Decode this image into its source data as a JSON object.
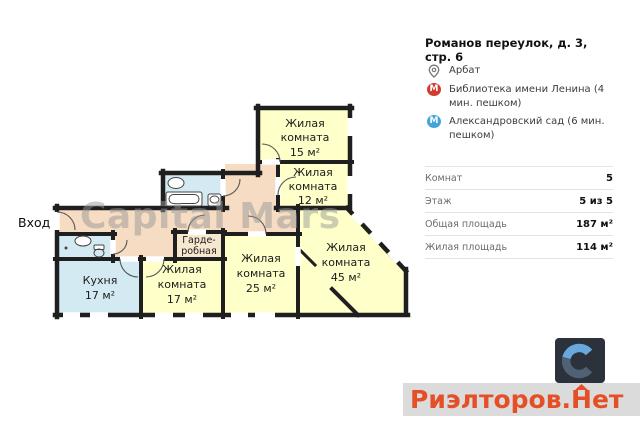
{
  "colors": {
    "wall": "#1f1f1f",
    "room_yellow": "#ffffc9",
    "room_blue": "#d3eaf2",
    "corridor_peach": "#f6dcc2",
    "wardrobe_peach": "#f8e7cf",
    "watermark_grey": "#9a9a9a",
    "metro_red": "#d23b33",
    "metro_blue": "#42a4d9",
    "accent_red": "#e44f27",
    "logo_square_bg": "#2c323b",
    "logo_c_top": "#68a8dc",
    "logo_c_bottom": "#4e6175",
    "banner_bg": "#dbdbdb",
    "divider": "#e3e3e3",
    "text_grey": "#6b6b6b"
  },
  "plan": {
    "entrance_label": "Вход",
    "watermark": "Capital Mars",
    "rooms": [
      {
        "id": "living-15",
        "lines": [
          "Жилая",
          "комната",
          "15 м²"
        ]
      },
      {
        "id": "living-12",
        "lines": [
          "Жилая",
          "комната",
          "12 м²"
        ]
      },
      {
        "id": "living-17",
        "lines": [
          "Жилая",
          "комната",
          "17 м²"
        ]
      },
      {
        "id": "living-25",
        "lines": [
          "Жилая",
          "комната",
          "25 м²"
        ]
      },
      {
        "id": "living-45",
        "lines": [
          "Жилая",
          "комната",
          "45 м²"
        ]
      },
      {
        "id": "kitchen",
        "lines": [
          "Кухня",
          "17 м²"
        ]
      },
      {
        "id": "wardrobe",
        "lines": [
          "Гарде-",
          "робная"
        ]
      }
    ]
  },
  "details": {
    "title": "Романов переулок, д. 3, стр. 6",
    "location": {
      "label": "Арбат"
    },
    "metro_letter": "М",
    "metro": [
      {
        "name": "Библиотека имени Ленина (4 мин. пешком)"
      },
      {
        "name": "Александровский сад (6 мин. пешком)"
      }
    ],
    "specs": [
      {
        "label": "Комнат",
        "value": "5"
      },
      {
        "label": "Этаж",
        "value": "5 из 5"
      },
      {
        "label": "Общая площадь",
        "value": "187 м²"
      },
      {
        "label": "Жилая площадь",
        "value": "114 м²"
      }
    ]
  },
  "footer": {
    "brand_prefix": "Риэлторов.",
    "brand_house_letter": "Н",
    "brand_suffix": "ет"
  }
}
